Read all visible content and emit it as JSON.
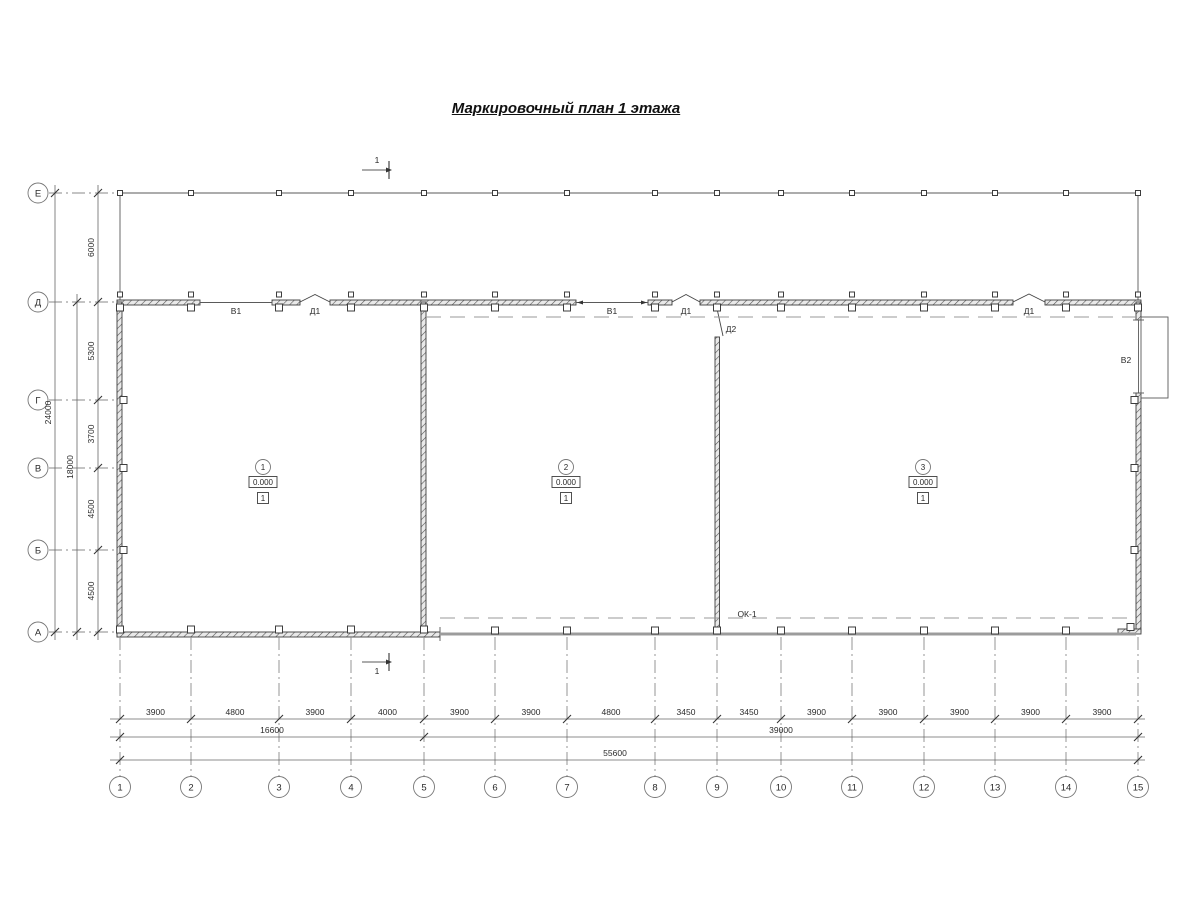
{
  "title": "Маркировочный план 1 этажа",
  "section_mark": {
    "label": "1"
  },
  "axes": {
    "rows": [
      {
        "label": "Е",
        "y": 193
      },
      {
        "label": "Д",
        "y": 302
      },
      {
        "label": "Г",
        "y": 400
      },
      {
        "label": "В",
        "y": 468
      },
      {
        "label": "Б",
        "y": 550
      },
      {
        "label": "А",
        "y": 632
      }
    ],
    "cols": [
      {
        "label": "1",
        "x": 120
      },
      {
        "label": "2",
        "x": 191
      },
      {
        "label": "3",
        "x": 279
      },
      {
        "label": "4",
        "x": 351
      },
      {
        "label": "5",
        "x": 424
      },
      {
        "label": "6",
        "x": 495
      },
      {
        "label": "7",
        "x": 567
      },
      {
        "label": "8",
        "x": 655
      },
      {
        "label": "9",
        "x": 717
      },
      {
        "label": "10",
        "x": 781
      },
      {
        "label": "11",
        "x": 852
      },
      {
        "label": "12",
        "x": 924
      },
      {
        "label": "13",
        "x": 995
      },
      {
        "label": "14",
        "x": 1066
      },
      {
        "label": "15",
        "x": 1138
      }
    ]
  },
  "left_dims": {
    "segments": [
      {
        "label": "6000",
        "from": 0,
        "to": 1
      },
      {
        "label": "5300",
        "from": 1,
        "to": 2
      },
      {
        "label": "3700",
        "from": 2,
        "to": 3
      },
      {
        "label": "4500",
        "from": 3,
        "to": 4
      },
      {
        "label": "4500",
        "from": 4,
        "to": 5
      }
    ],
    "subtotal": {
      "label": "18000",
      "from": 1,
      "to": 5
    },
    "total": {
      "label": "24000",
      "from": 0,
      "to": 5
    }
  },
  "bottom_dims": {
    "segments": [
      {
        "label": "3900"
      },
      {
        "label": "4800"
      },
      {
        "label": "3900"
      },
      {
        "label": "4000"
      },
      {
        "label": "3900"
      },
      {
        "label": "3900"
      },
      {
        "label": "4800"
      },
      {
        "label": "3450"
      },
      {
        "label": "3450"
      },
      {
        "label": "3900"
      },
      {
        "label": "3900"
      },
      {
        "label": "3900"
      },
      {
        "label": "3900"
      },
      {
        "label": "3900"
      }
    ],
    "subtotals": [
      {
        "label": "16600",
        "from": 0,
        "to": 4
      },
      {
        "label": "39000",
        "from": 4,
        "to": 14
      }
    ],
    "total": {
      "label": "55600",
      "from": 0,
      "to": 14
    }
  },
  "rooms": [
    {
      "number": "1",
      "elevation": "0.000",
      "floor_type": "1",
      "cx": 263,
      "cy": 467
    },
    {
      "number": "2",
      "elevation": "0.000",
      "floor_type": "1",
      "cx": 566,
      "cy": 467
    },
    {
      "number": "3",
      "elevation": "0.000",
      "floor_type": "1",
      "cx": 923,
      "cy": 467
    }
  ],
  "opening_labels": [
    {
      "label": "В1",
      "x": 236,
      "y": 314
    },
    {
      "label": "Д1",
      "x": 315,
      "y": 314
    },
    {
      "label": "В1",
      "x": 612,
      "y": 314
    },
    {
      "label": "Д1",
      "x": 686,
      "y": 314
    },
    {
      "label": "Д2",
      "x": 731,
      "y": 332
    },
    {
      "label": "Д1",
      "x": 1029,
      "y": 314
    },
    {
      "label": "В2",
      "x": 1126,
      "y": 363
    },
    {
      "label": "ОК-1",
      "x": 747,
      "y": 617
    }
  ]
}
